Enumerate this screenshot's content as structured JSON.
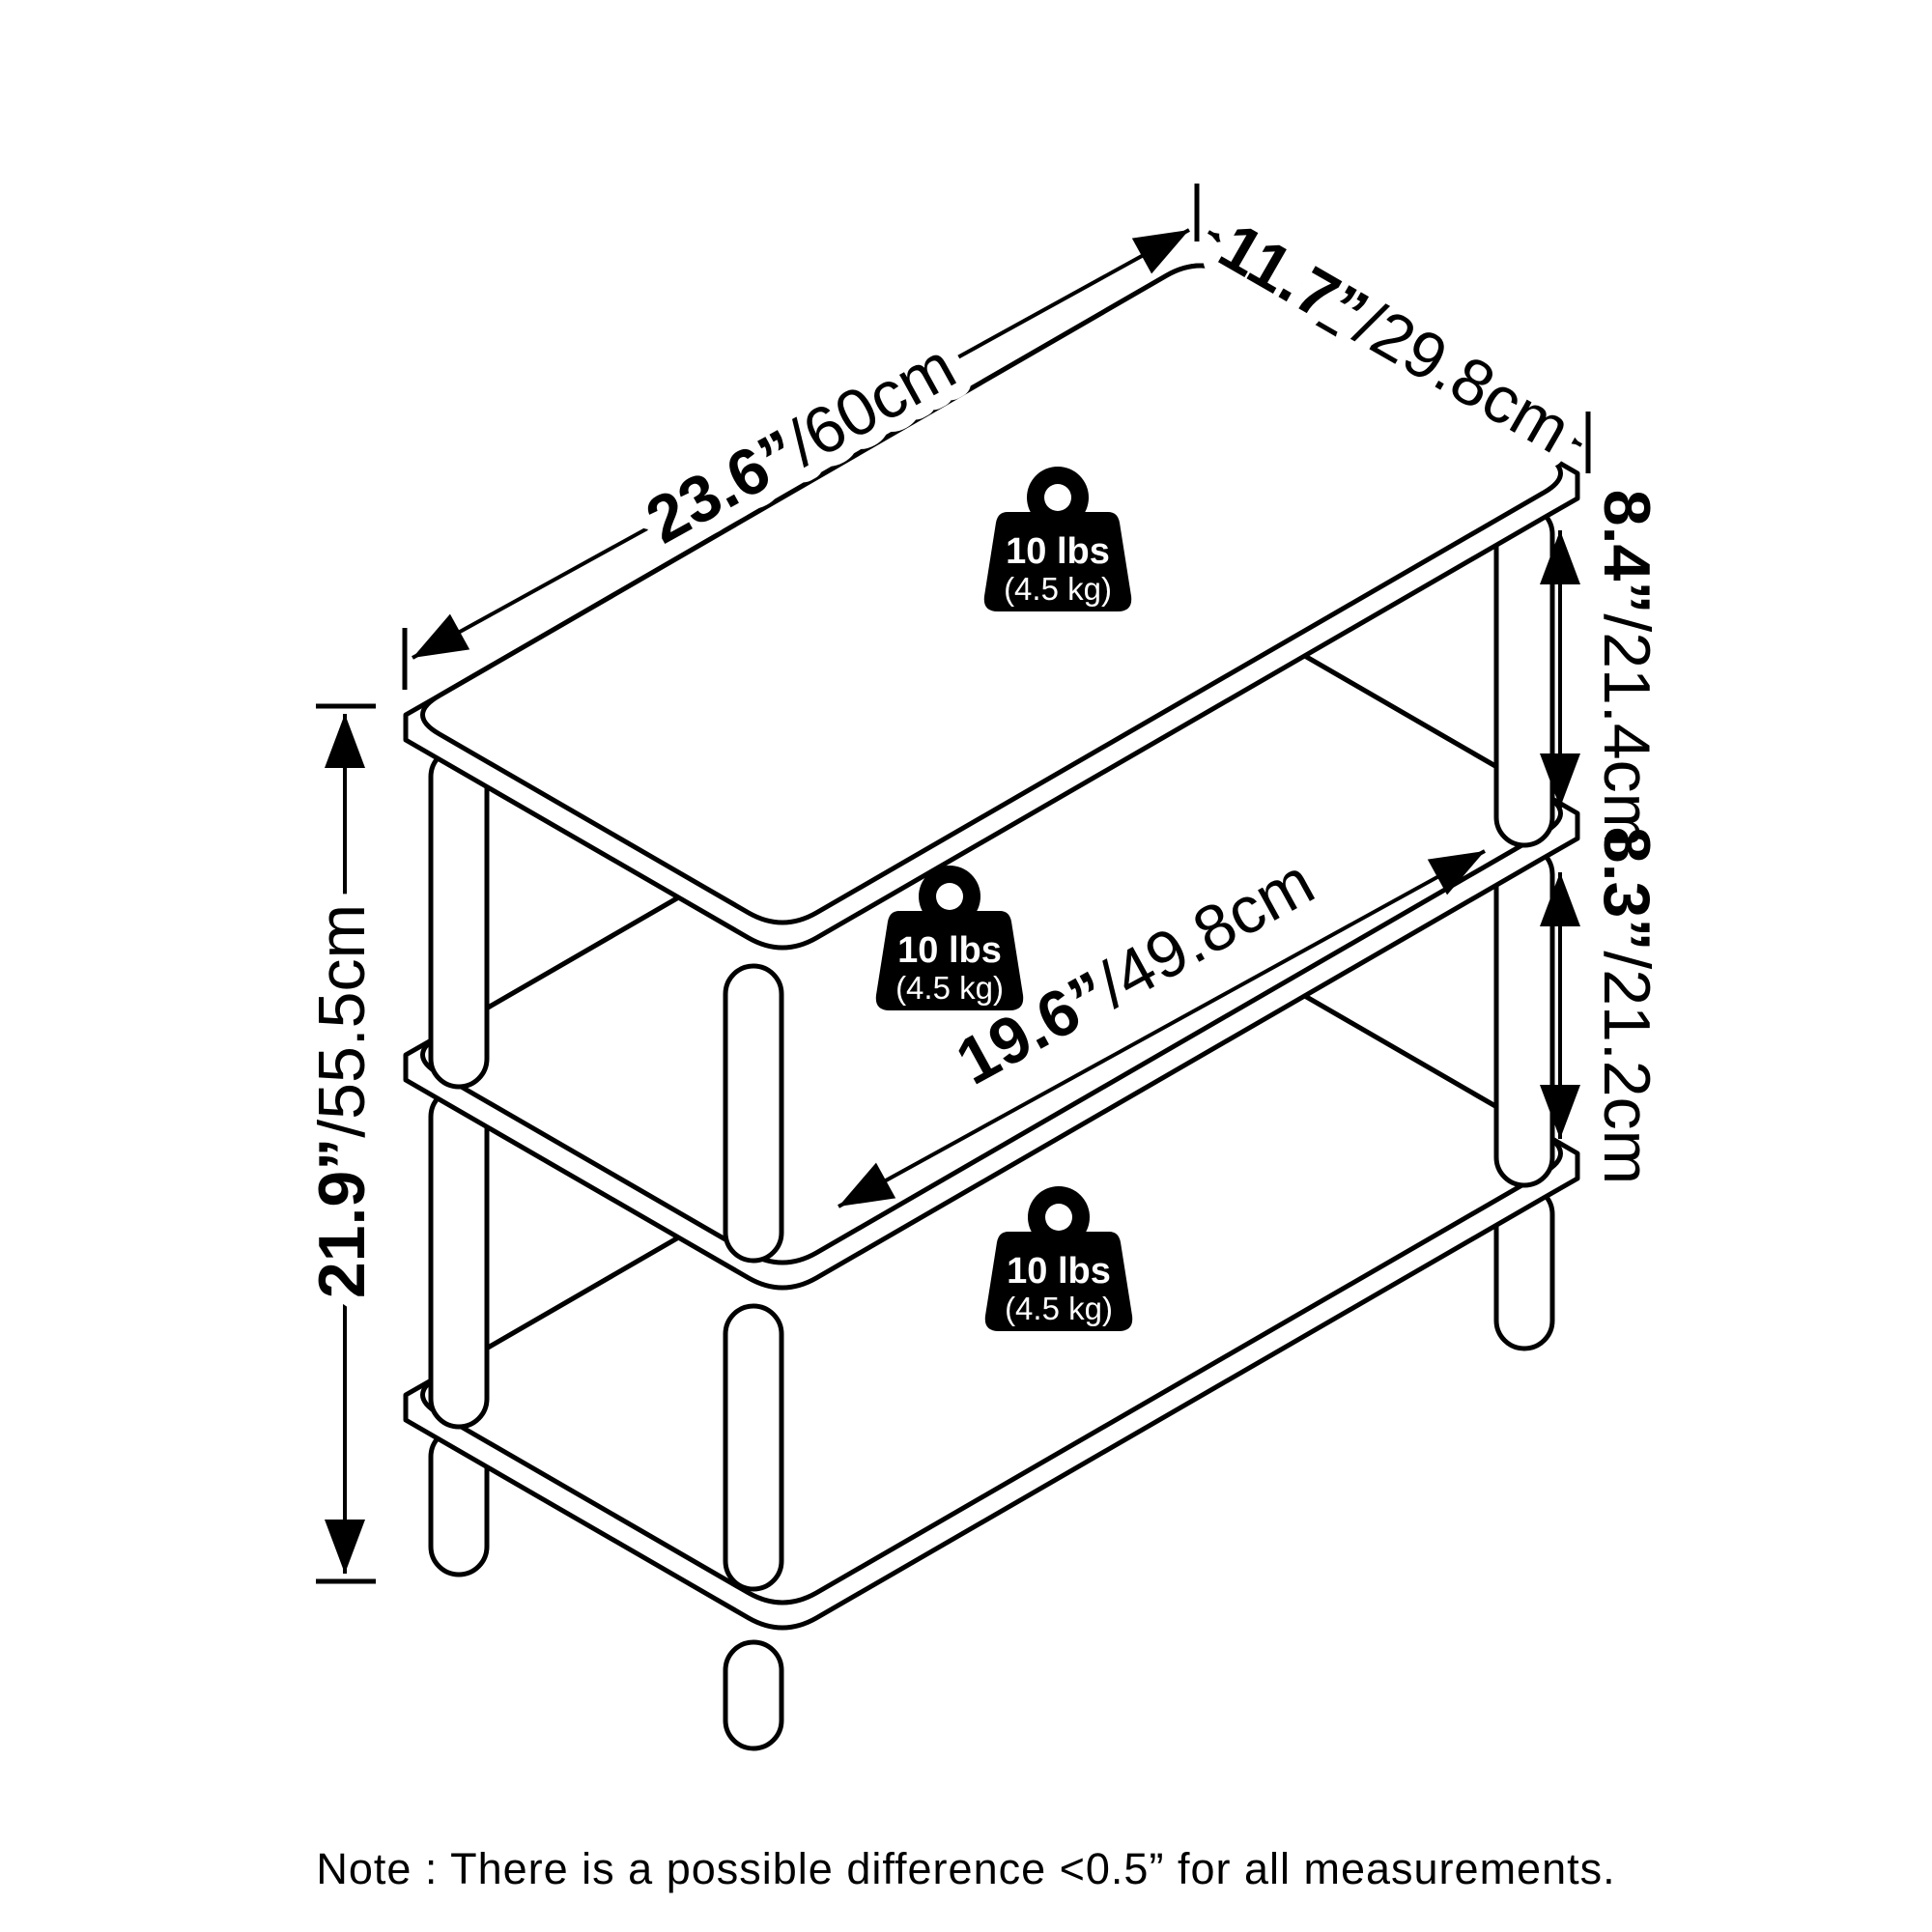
{
  "figure": {
    "type": "isometric-furniture-dimension-diagram",
    "product": "3-tier shelf stand",
    "colors": {
      "line": "#000000",
      "background": "#ffffff"
    },
    "dimensions": {
      "top_length": {
        "inches": "23.6”",
        "cm": "/60cm"
      },
      "top_depth": {
        "inches": "11.7”",
        "cm": "/29.8cm"
      },
      "upper_clearance": {
        "inches": "8.4”",
        "cm": "/21.4cm"
      },
      "lower_clearance": {
        "inches": "8.3”",
        "cm": "/21.2cm"
      },
      "shelf_length": {
        "inches": "19.6”",
        "cm": "/49.8cm"
      },
      "total_height": {
        "inches": "21.9”",
        "cm": "/55.5cm"
      }
    },
    "weight_capacity": {
      "lbs": "10 lbs",
      "kg": "(4.5 kg)"
    },
    "note": "Note : There is a possible difference <0.5” for all measurements."
  }
}
